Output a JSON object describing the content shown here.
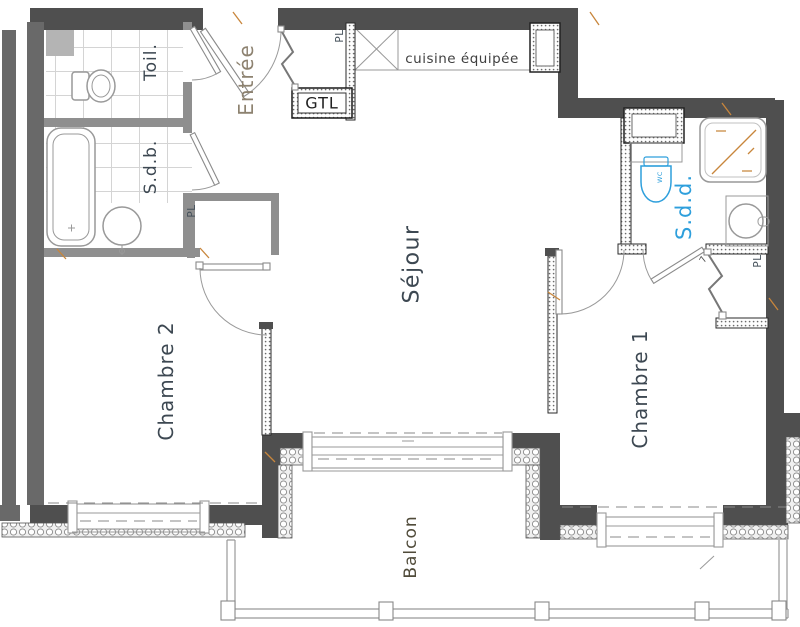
{
  "rooms": {
    "entree": "Entrée",
    "toilette": "Toil.",
    "sdb": "S.d.b.",
    "cuisine": "cuisine équipée",
    "gtl": "GTL",
    "sejour": "Séjour",
    "sdd": "S.d.d.",
    "chambre1": "Chambre 1",
    "chambre2": "Chambre 2",
    "balcon": "Balcon",
    "placard": "PL",
    "wc": "WC"
  },
  "annotations": {
    "door_mark": "7"
  },
  "colors": {
    "wallDark": "#4f4f4f",
    "wallSide": "#696969",
    "wallMedium": "#8f8f8f",
    "closetGray": "#b4b4b4",
    "lineGray": "#999999",
    "labelSlate": "#3d4852",
    "labelTan": "#8d8270",
    "labelOlive": "#504b3a",
    "labelDark": "#3f3f3f",
    "accentBlue": "#2e9fdc",
    "tickTan": "#c8863c"
  }
}
